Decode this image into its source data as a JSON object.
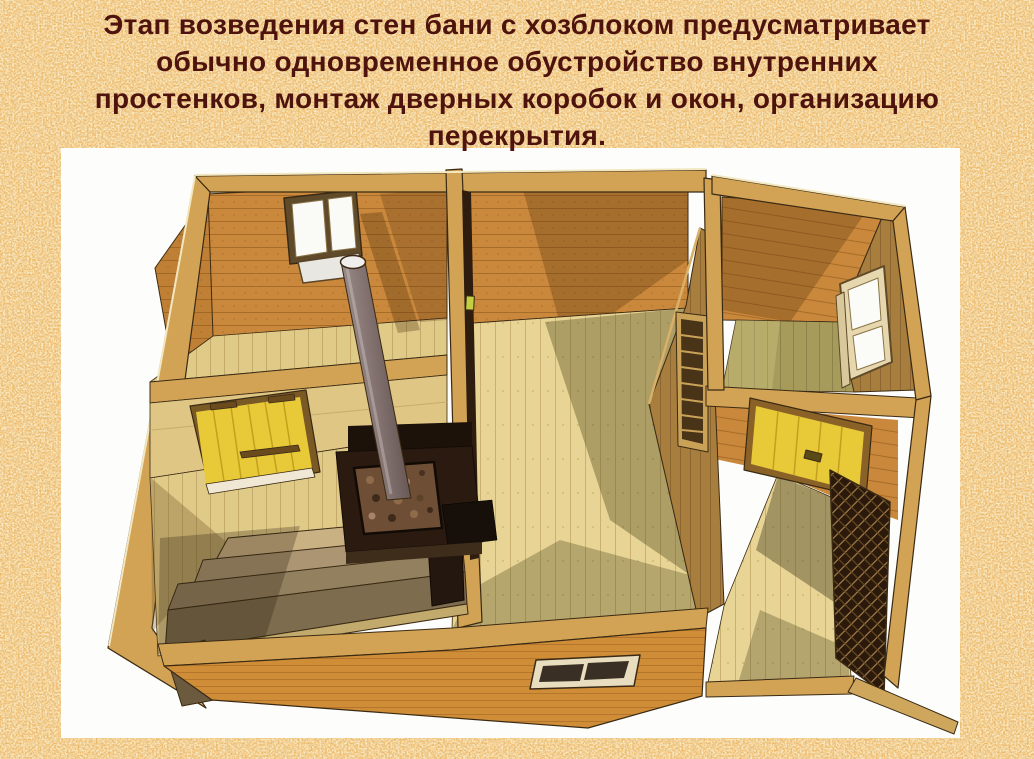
{
  "slide": {
    "background_color": "#ecb661",
    "caption": {
      "text_color": "#4e130d",
      "lines": [
        "Этап возведения стен бани с хозблоком предусматривает",
        "обычно одновременное обустройство внутренних",
        "простенков, монтаж дверных коробок и окон, организацию",
        "перекрытия."
      ]
    }
  },
  "illustration": {
    "description": "3D cutaway model of a log bathhouse (banya) with utility block: steam room with tiered benches, sauna stove with stones and tall chimney pipe, yellow plank doors, window openings, interior partitions, ventilation louver and entrance porch with dark lattice screen",
    "panel_color": "#fdfdfb",
    "colors": {
      "wall_planks": "#c9883c",
      "floor_planks": "#e8d494",
      "wall_top_edges": "#d3a355",
      "door_yellow": "#e8c937",
      "stove": "#2a1a10",
      "chimney": "#8b7b79",
      "lattice": "#2b1a0c"
    }
  }
}
